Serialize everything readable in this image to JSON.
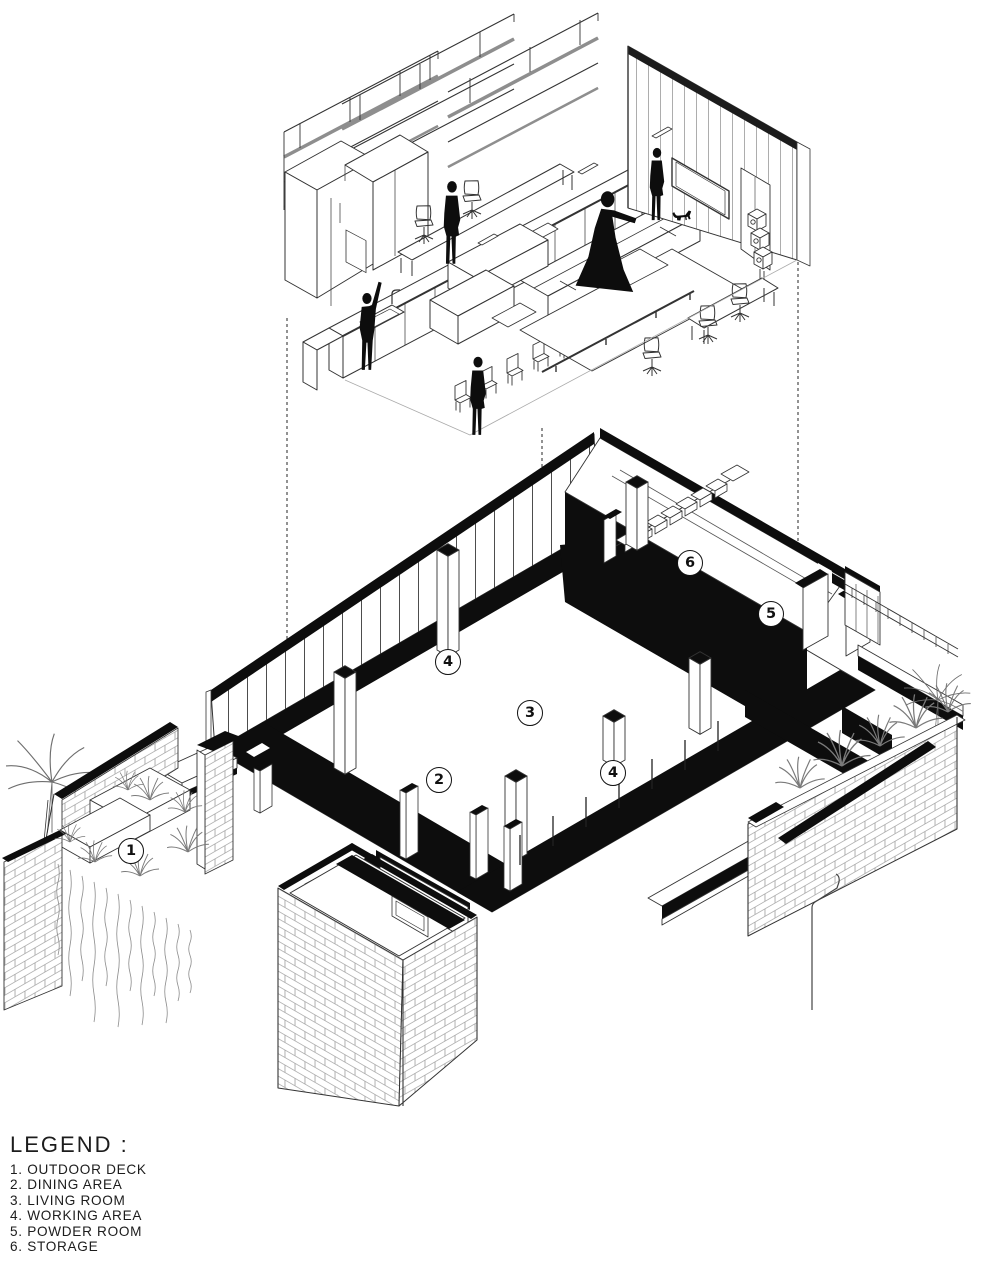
{
  "legend": {
    "title": "LEGEND :",
    "items": [
      "1. OUTDOOR DECK",
      "2. DINING AREA",
      "3. LIVING ROOM",
      "4. WORKING AREA",
      "5. POWDER ROOM",
      "6. STORAGE"
    ]
  },
  "callouts": [
    {
      "n": "1",
      "room": "OUTDOOR DECK"
    },
    {
      "n": "2",
      "room": "DINING AREA"
    },
    {
      "n": "3",
      "room": "LIVING ROOM"
    },
    {
      "n": "4",
      "room": "WORKING AREA"
    },
    {
      "n": "4",
      "room": "WORKING AREA"
    },
    {
      "n": "5",
      "room": "POWDER ROOM"
    },
    {
      "n": "6",
      "room": "STORAGE"
    }
  ],
  "drawing": {
    "ink": "#111111",
    "line": "#333333",
    "background": "#ffffff"
  }
}
